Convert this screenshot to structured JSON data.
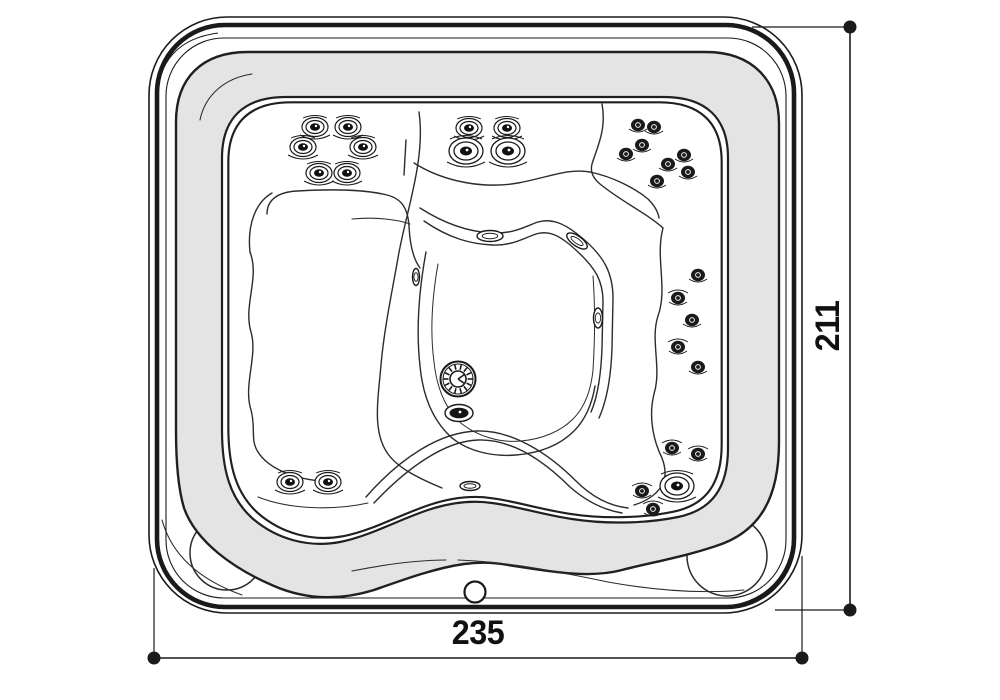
{
  "title": "hot-tub-top-view-technical-drawing",
  "colors": {
    "line": "#1a1a1a",
    "thin_line": "#2c2c2c",
    "rim_fill": "#e4e4e4",
    "background": "#ffffff",
    "text": "#111111"
  },
  "dimensions": {
    "width": {
      "label": "235",
      "line": {
        "x1": 154,
        "y1": 658,
        "x2": 802,
        "y2": 658
      },
      "ext": [
        {
          "x1": 154,
          "y1": 568,
          "x2": 154,
          "y2": 658
        },
        {
          "x1": 802,
          "y1": 556,
          "x2": 802,
          "y2": 658
        }
      ],
      "dots": [
        [
          154,
          658
        ],
        [
          802,
          658
        ]
      ],
      "label_pos": {
        "x": 478,
        "y": 616
      }
    },
    "height": {
      "label": "211",
      "line": {
        "x1": 850,
        "y1": 27,
        "x2": 850,
        "y2": 610
      },
      "ext": [
        {
          "x1": 752,
          "y1": 27,
          "x2": 850,
          "y2": 27
        },
        {
          "x1": 775,
          "y1": 610,
          "x2": 850,
          "y2": 610
        }
      ],
      "dots": [
        [
          850,
          27
        ],
        [
          850,
          610
        ]
      ],
      "label_pos": {
        "x": 828,
        "y": 326
      }
    },
    "dot_radius": 6.5,
    "line_width": 1.6
  },
  "drain": {
    "cx": 458,
    "cy": 379,
    "r_outer": 17.5,
    "r_ring": 15,
    "r_inner": 8,
    "ticks": 14
  },
  "jets": [
    {
      "x": 315,
      "y": 127,
      "s": "md"
    },
    {
      "x": 348,
      "y": 127,
      "s": "md"
    },
    {
      "x": 303,
      "y": 147,
      "s": "md"
    },
    {
      "x": 363,
      "y": 147,
      "s": "md"
    },
    {
      "x": 319,
      "y": 173,
      "s": "md"
    },
    {
      "x": 347,
      "y": 173,
      "s": "md"
    },
    {
      "x": 469,
      "y": 128,
      "s": "md"
    },
    {
      "x": 507,
      "y": 128,
      "s": "md"
    },
    {
      "x": 466,
      "y": 151,
      "s": "lg"
    },
    {
      "x": 508,
      "y": 151,
      "s": "lg"
    },
    {
      "x": 638,
      "y": 125,
      "s": "sm"
    },
    {
      "x": 654,
      "y": 127,
      "s": "sm"
    },
    {
      "x": 642,
      "y": 145,
      "s": "sm"
    },
    {
      "x": 626,
      "y": 154,
      "s": "sm"
    },
    {
      "x": 684,
      "y": 155,
      "s": "sm"
    },
    {
      "x": 668,
      "y": 164,
      "s": "sm"
    },
    {
      "x": 688,
      "y": 172,
      "s": "sm"
    },
    {
      "x": 657,
      "y": 181,
      "s": "sm"
    },
    {
      "x": 698,
      "y": 275,
      "s": "sm"
    },
    {
      "x": 678,
      "y": 298,
      "s": "smd"
    },
    {
      "x": 692,
      "y": 320,
      "s": "sm"
    },
    {
      "x": 678,
      "y": 347,
      "s": "smd"
    },
    {
      "x": 698,
      "y": 367,
      "s": "sm"
    },
    {
      "x": 672,
      "y": 448,
      "s": "smd"
    },
    {
      "x": 698,
      "y": 454,
      "s": "smd"
    },
    {
      "x": 677,
      "y": 486,
      "s": "lg"
    },
    {
      "x": 642,
      "y": 491,
      "s": "smd"
    },
    {
      "x": 653,
      "y": 509,
      "s": "smd"
    },
    {
      "x": 290,
      "y": 482,
      "s": "md"
    },
    {
      "x": 328,
      "y": 482,
      "s": "md"
    }
  ],
  "fittings": [
    {
      "type": "oval-white",
      "x": 490,
      "y": 236,
      "rx": 13,
      "ry": 5.5,
      "rot": 0
    },
    {
      "type": "oval-white",
      "x": 577,
      "y": 241,
      "rx": 12,
      "ry": 5,
      "rot": 35
    },
    {
      "type": "oval-white",
      "x": 416,
      "y": 277,
      "rx": 3.5,
      "ry": 8.5,
      "rot": 0
    },
    {
      "type": "oval-white",
      "x": 598,
      "y": 318,
      "rx": 4.5,
      "ry": 10,
      "rot": 0
    },
    {
      "type": "oval-dark",
      "x": 459,
      "y": 413,
      "rx": 14,
      "ry": 8.5,
      "rot": 0
    },
    {
      "type": "oval-white",
      "x": 470,
      "y": 486,
      "rx": 10,
      "ry": 4.5,
      "rot": 0
    },
    {
      "type": "circle",
      "x": 475,
      "y": 592,
      "rx": 10.5,
      "ry": 10.5,
      "rot": 0
    }
  ]
}
